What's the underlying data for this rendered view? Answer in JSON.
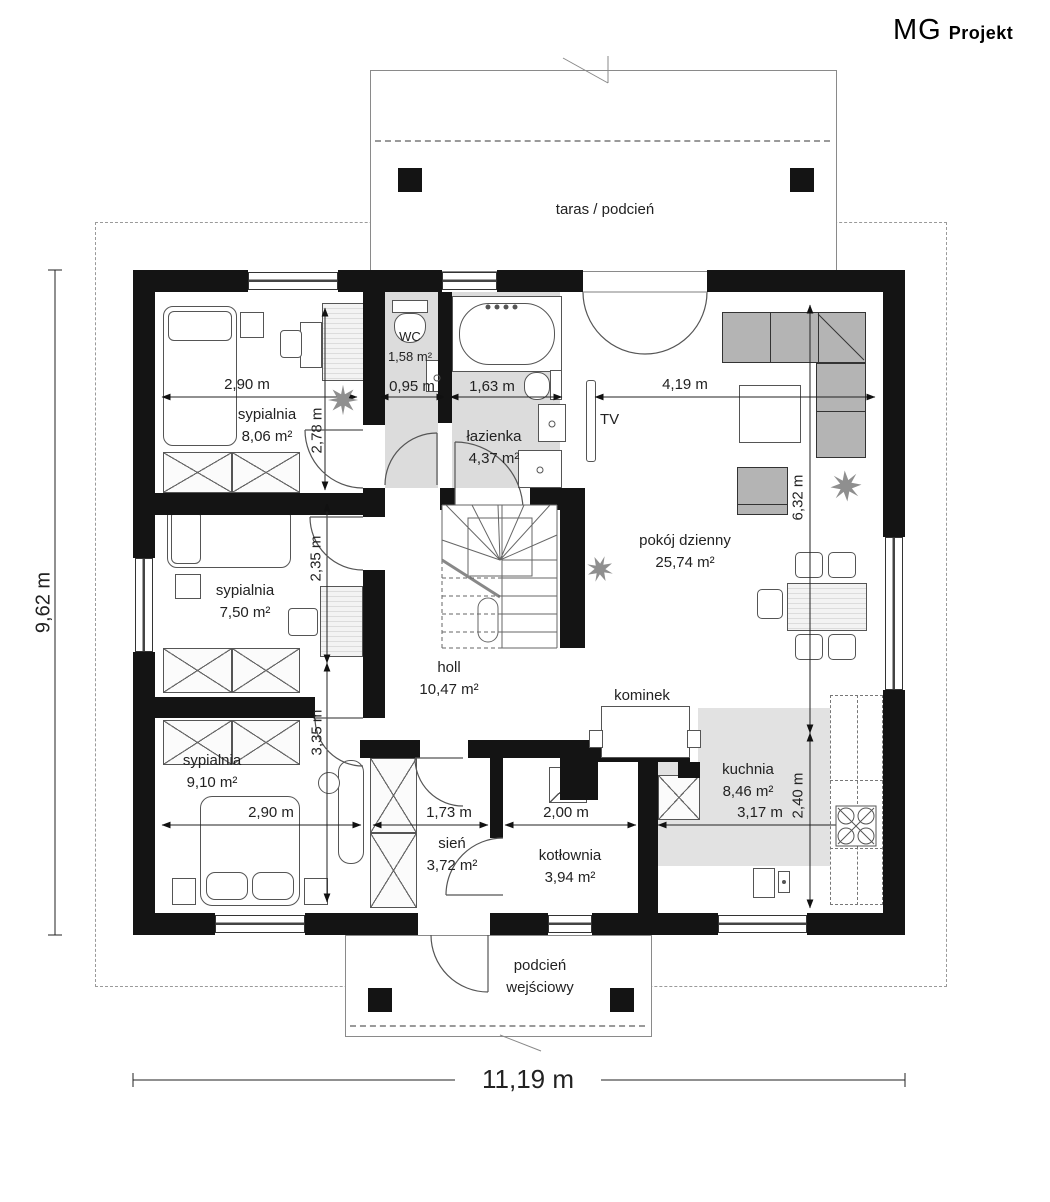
{
  "brand": {
    "mg": "MG",
    "projekt": "Projekt"
  },
  "outdoor": {
    "terrace_label": "taras / podcień",
    "porch_line1": "podcień",
    "porch_line2": "wejściowy"
  },
  "rooms": [
    {
      "name": "sypialnia",
      "area": "8,06 m²"
    },
    {
      "name": "WC",
      "area": "1,58 m²"
    },
    {
      "name": "łazienka",
      "area": "4,37 m²"
    },
    {
      "name": "pokój dzienny",
      "area": "25,74 m²"
    },
    {
      "name": "holl",
      "area": "10,47 m²"
    },
    {
      "name": "sypialnia",
      "area": "7,50 m²"
    },
    {
      "name": "sypialnia",
      "area": "9,10 m²"
    },
    {
      "name": "sień",
      "area": "3,72 m²"
    },
    {
      "name": "kotłownia",
      "area": "3,94 m²"
    },
    {
      "name": "kuchnia",
      "area": "8,46 m²"
    }
  ],
  "features": {
    "tv": "TV",
    "fireplace": "kominek"
  },
  "dims": {
    "syp1_w": "2,90 m",
    "wc_w": "0,95 m",
    "bath_w": "1,63 m",
    "living_w": "4,19 m",
    "syp1_h": "2,78 m",
    "syp2_h": "2,35 m",
    "syp3_h": "3,35 m",
    "living_h": "6,32 m",
    "kitchen_h": "2,40 m",
    "syp3_w": "2,90 m",
    "hall_w": "1,73 m",
    "boiler_w": "2,00 m",
    "kitchen_w": "3,17 m",
    "total_w": "11,19 m",
    "total_h": "9,62 m"
  }
}
